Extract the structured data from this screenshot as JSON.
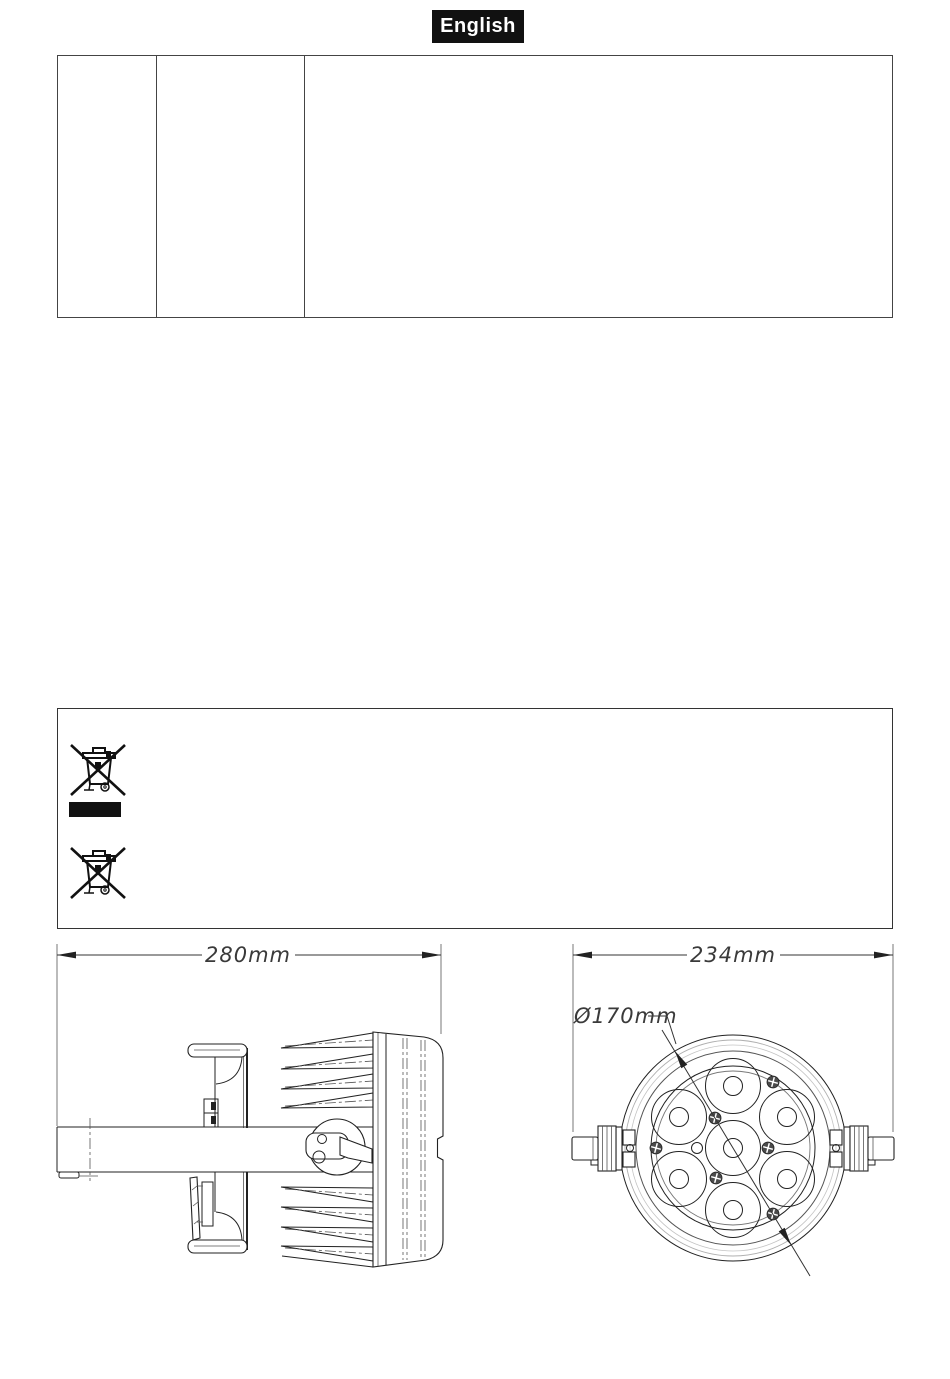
{
  "badge": {
    "label": "English"
  },
  "spec_table": {
    "column_count": 3,
    "cells": [
      "",
      "",
      ""
    ]
  },
  "notice_box": {
    "symbols": [
      {
        "name": "weee-crossed-out-wheelie-bin-icon"
      },
      {
        "name": "black-bar"
      },
      {
        "name": "weee-crossed-out-wheelie-bin-icon"
      }
    ]
  },
  "drawings": {
    "side_view": {
      "width_dimension": "280mm"
    },
    "front_view": {
      "width_dimension": "234mm",
      "lens_circle_diameter": "Ø170mm",
      "led_lens_count": 7
    }
  },
  "colors": {
    "line_art": "#222222",
    "badge_bg": "#111111",
    "badge_text": "#ffffff"
  }
}
